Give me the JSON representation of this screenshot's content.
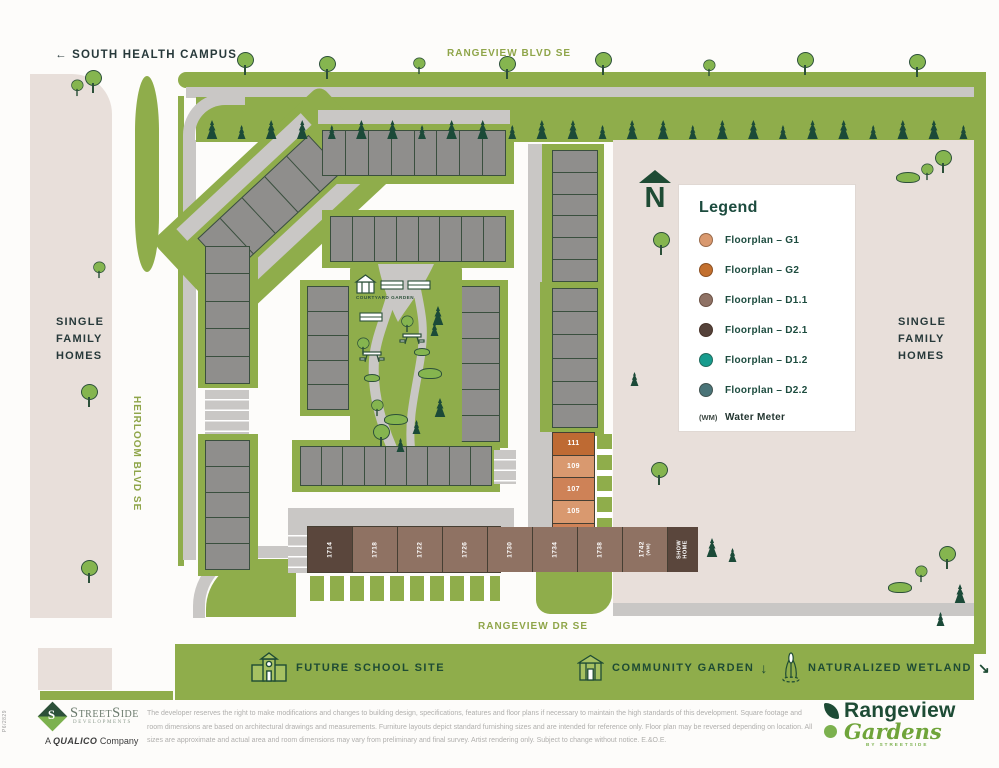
{
  "streets": {
    "south_health_campus": "← SOUTH HEALTH CAMPUS",
    "rangeview_blvd": "RANGEVIEW BLVD SE",
    "heirloom_blvd": "HEIRLOOM BLVD SE",
    "rangeview_dr": "RANGEVIEW DR SE"
  },
  "areas": {
    "single_family_left": "SINGLE FAMILY HOMES",
    "single_family_right": "SINGLE FAMILY HOMES",
    "courtyard": "COURTYARD GARDEN"
  },
  "north_letter": "N",
  "legend": {
    "title": "Legend",
    "items": [
      {
        "label": "Floorplan – G1",
        "color": "#D9996F"
      },
      {
        "label": "Floorplan – G2",
        "color": "#C3702F"
      },
      {
        "label": "Floorplan – D1.1",
        "color": "#8F7265"
      },
      {
        "label": "Floorplan – D2.1",
        "color": "#55423A"
      },
      {
        "label": "Floorplan – D1.2",
        "color": "#179C8E"
      },
      {
        "label": "Floorplan – D2.2",
        "color": "#4A7478"
      }
    ],
    "wm_symbol": "(WM)",
    "wm_label": "Water Meter"
  },
  "lots_right": [
    {
      "num": "111",
      "fill": "#BE6A33"
    },
    {
      "num": "109",
      "fill": "#D9996F"
    },
    {
      "num": "107",
      "fill": "#CE8257"
    },
    {
      "num": "105",
      "fill": "#D9996F"
    },
    {
      "num": "103",
      "sub": "(WM)",
      "fill": "#CE8257"
    },
    {
      "num": "101",
      "fill": "#BE6A33"
    }
  ],
  "lots_bottom": [
    {
      "num": "1714",
      "fill": "#5A463C"
    },
    {
      "num": "1718",
      "fill": "#8F7263"
    },
    {
      "num": "1722",
      "fill": "#8F7263"
    },
    {
      "num": "1726",
      "fill": "#8F7263"
    },
    {
      "num": "1730",
      "fill": "#8F7263"
    },
    {
      "num": "1734",
      "fill": "#8F7263"
    },
    {
      "num": "1738",
      "fill": "#8F7263"
    },
    {
      "num": "1742",
      "sub": "(WM)",
      "fill": "#8F7263"
    },
    {
      "num": "SHOW HOME",
      "fill": "#5A463C",
      "two_line": true
    }
  ],
  "bottom_bar": {
    "school": "FUTURE SCHOOL SITE",
    "community": "COMMUNITY GARDEN",
    "community_arrow": "↓",
    "wetland": "NATURALIZED WETLAND",
    "wetland_arrow": "↘"
  },
  "footer": {
    "side_code": "P6/2829",
    "streetside_name": "StreetSide",
    "streetside_sub": "DEVELOPMENTS",
    "streetside_s": "S",
    "qualico_a": "A",
    "qualico_name": "QUALICO",
    "qualico_company": "Company",
    "disclaimer": "The developer reserves the right to make modifications and changes to building design, specifications, features and floor plans if necessary to maintain the high standards of this development. Square footage and room dimensions are based on architectural drawings and measurements. Furniture layouts depict standard furnishing sizes and are intended for reference only. Floor plan may be reversed depending on location. All sizes are approximate and actual area and room dimensions may vary from preliminary and final survey. Artist rendering only. Subject to change without notice. E.&O.E.",
    "brand_name": "Rangeview",
    "brand_script": "Gardens",
    "brand_by": "BY STREETSIDE"
  }
}
